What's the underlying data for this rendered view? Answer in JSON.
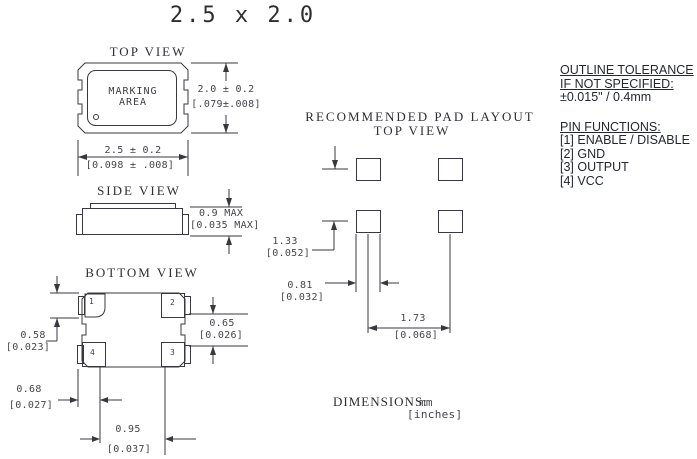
{
  "title": "2.5 x 2.0",
  "top_view": {
    "label": "TOP VIEW",
    "marking_line1": "MARKING",
    "marking_line2": "AREA",
    "height_mm": "2.0 ± 0.2",
    "height_in": "[.079±.008]",
    "width_mm": "2.5 ± 0.2",
    "width_in": "[0.098 ± .008]"
  },
  "side_view": {
    "label": "SIDE VIEW",
    "thickness_mm": "0.9 MAX",
    "thickness_in": "[0.035 MAX]"
  },
  "bottom_view": {
    "label": "BOTTOM VIEW",
    "pad_numbers": {
      "top_left": "1",
      "top_right": "2",
      "bottom_left": "4",
      "bottom_right": "3"
    },
    "pad_height_mm": "0.58",
    "pad_height_in": "[0.023]",
    "pad_width_mm": "0.68",
    "pad_width_in": "[0.027]",
    "pad_gap_mm": "0.65",
    "pad_gap_in": "[0.026]",
    "pad_span_mm": "0.95",
    "pad_span_in": "[0.037]"
  },
  "pad_layout": {
    "label_line1": "RECOMMENDED PAD LAYOUT",
    "label_line2": "TOP VIEW",
    "row_pitch_mm": "1.33",
    "row_pitch_in": "[0.052]",
    "pad_width_mm": "0.81",
    "pad_width_in": "[0.032]",
    "col_pitch_mm": "1.73",
    "col_pitch_in": "[0.068]"
  },
  "notes": {
    "tolerance_heading_line1": "OUTLINE TOLERANCE",
    "tolerance_heading_line2": "IF NOT SPECIFIED:",
    "tolerance_value": "±0.015\" / 0.4mm",
    "pin_functions_heading": "PIN FUNCTIONS:",
    "pins": [
      "[1] ENABLE / DISABLE",
      "[2] GND",
      "[3] OUTPUT",
      "[4] VCC"
    ]
  },
  "units_note": {
    "label": "DIMENSIONS:",
    "unit_primary": "mm",
    "unit_secondary": "[inches]"
  }
}
